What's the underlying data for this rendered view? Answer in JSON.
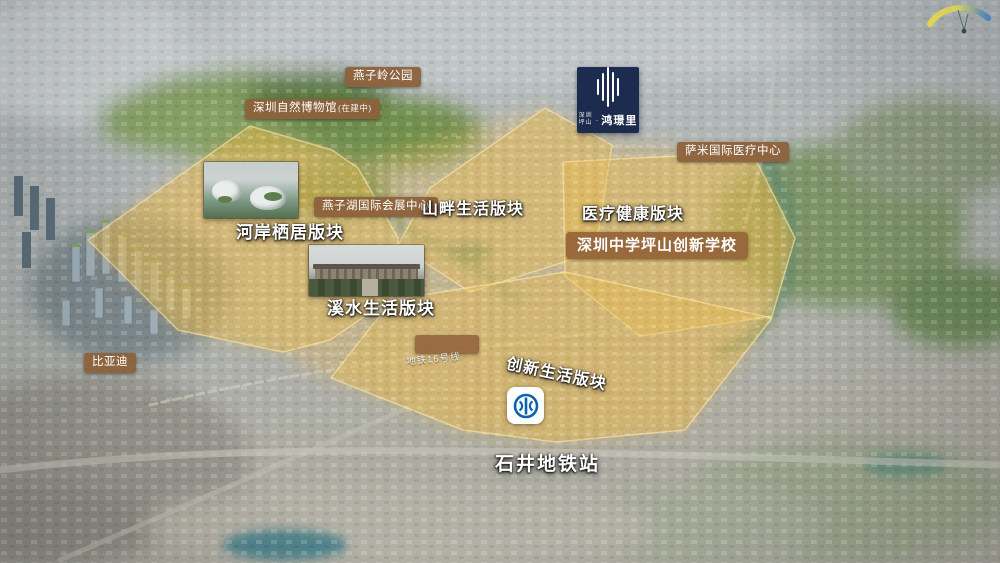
{
  "logo": {
    "prefix_line1": "深圳",
    "prefix_line2": "坪山",
    "separator": "·",
    "name": "鸿璟里"
  },
  "badges": {
    "yanziling_park": "燕子岭公园",
    "nature_museum": "深圳自然博物馆",
    "nature_museum_status": "(在建中)",
    "yanzihu_expo": "燕子湖国际会展中心",
    "sami_medical": "萨米国际医疗中心",
    "byd": "比亚迪",
    "school": "深圳中学坪山创新学校"
  },
  "zones": {
    "mountain": "山畔生活版块",
    "medical": "医疗健康版块",
    "riverside": "河岸栖居版块",
    "creek": "溪水生活版块",
    "innovation": "创新生活版块"
  },
  "transit": {
    "station": "石井地铁站",
    "line": "地铁16号线"
  },
  "colors": {
    "zone_highlight": "#e9bb4d",
    "badge_brown": "#8c613c",
    "logo_navy": "#1d2c4e",
    "metro_blue": "#0a62b1",
    "river_teal": "#4f8577"
  }
}
